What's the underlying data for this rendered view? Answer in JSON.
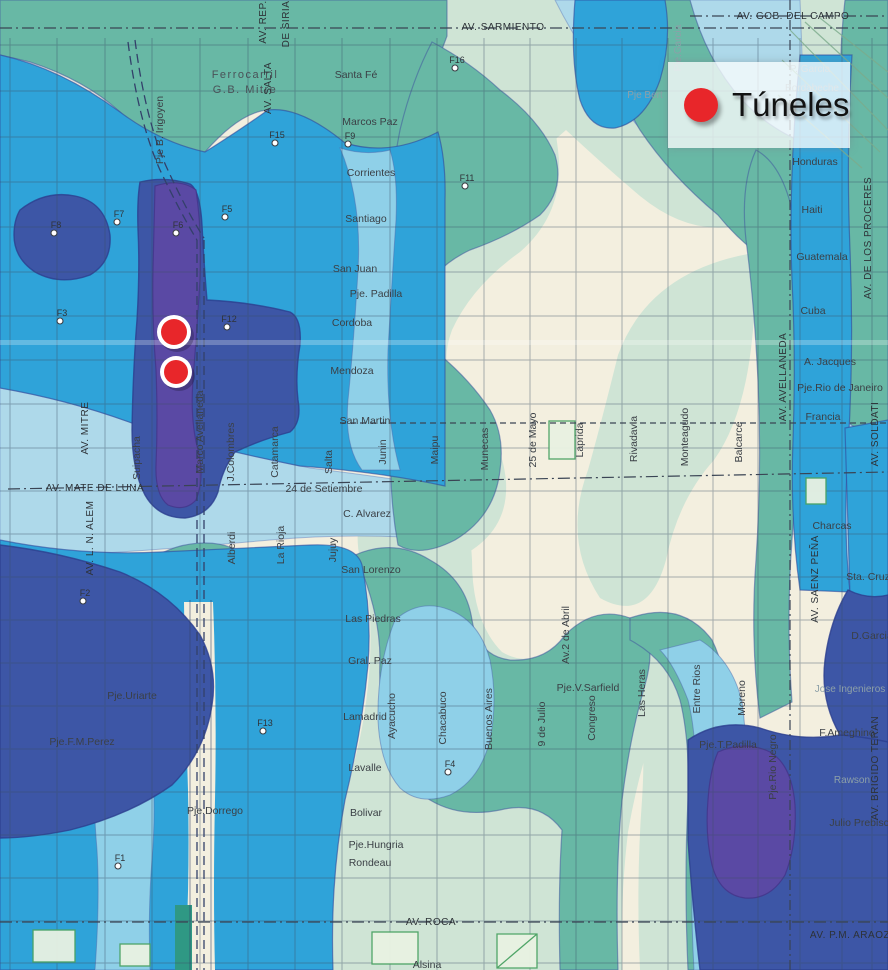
{
  "legend": {
    "title": "Túneles"
  },
  "colors": {
    "tunnel_red": "#e8262a",
    "navy": "#3d56a6",
    "purple": "#5a49a4",
    "blue": "#2fa3d9",
    "cyan": "#8fd0e8",
    "pale_blue": "#aed9ea",
    "teal": "#68b8a5",
    "pale_green": "#cfe4d5",
    "cream": "#f3efdf"
  },
  "tunnels": [
    {
      "x": 174,
      "y": 332,
      "r": 13
    },
    {
      "x": 176,
      "y": 372,
      "r": 12
    }
  ],
  "survey_points": [
    {
      "label": "F1",
      "x": 118,
      "y": 866
    },
    {
      "label": "F2",
      "x": 83,
      "y": 601
    },
    {
      "label": "F3",
      "x": 60,
      "y": 321
    },
    {
      "label": "F4",
      "x": 448,
      "y": 772
    },
    {
      "label": "F5",
      "x": 225,
      "y": 217
    },
    {
      "label": "F6",
      "x": 176,
      "y": 233
    },
    {
      "label": "F7",
      "x": 117,
      "y": 222
    },
    {
      "label": "F8",
      "x": 54,
      "y": 233
    },
    {
      "label": "F9",
      "x": 348,
      "y": 144
    },
    {
      "label": "F11",
      "x": 465,
      "y": 186
    },
    {
      "label": "F12",
      "x": 227,
      "y": 327
    },
    {
      "label": "F13",
      "x": 263,
      "y": 731
    },
    {
      "label": "F15",
      "x": 275,
      "y": 143
    },
    {
      "label": "F16",
      "x": 455,
      "y": 68
    }
  ],
  "labels": {
    "horizontal": [
      {
        "id": "av-sarmiento",
        "text": "AV. SARMIENTO",
        "x": 503,
        "y": 30,
        "cls": "avenue"
      },
      {
        "id": "av-gob-del-campo",
        "text": "AV. GOB. DEL CAMPO",
        "x": 793,
        "y": 19,
        "cls": "avenue"
      },
      {
        "id": "ferrocarril-1",
        "text": "Ferrocarril",
        "x": 245,
        "y": 78,
        "cls": "rail"
      },
      {
        "id": "ferrocarril-2",
        "text": "G.B. Mitre",
        "x": 245,
        "y": 93,
        "cls": "rail"
      },
      {
        "id": "santa-fe",
        "text": "Santa Fé",
        "x": 356,
        "y": 78,
        "cls": "street"
      },
      {
        "id": "marcos-paz",
        "text": "Marcos Paz",
        "x": 370,
        "y": 125,
        "cls": "street"
      },
      {
        "id": "corrientes",
        "text": "Corrientes",
        "x": 371,
        "y": 176,
        "cls": "street"
      },
      {
        "id": "santiago",
        "text": "Santiago",
        "x": 366,
        "y": 222,
        "cls": "street"
      },
      {
        "id": "san-juan",
        "text": "San Juan",
        "x": 355,
        "y": 272,
        "cls": "street"
      },
      {
        "id": "pje-padilla",
        "text": "Pje. Padilla",
        "x": 376,
        "y": 297,
        "cls": "street"
      },
      {
        "id": "cordoba",
        "text": "Cordoba",
        "x": 352,
        "y": 326,
        "cls": "street"
      },
      {
        "id": "mendoza",
        "text": "Mendoza",
        "x": 352,
        "y": 374,
        "cls": "street"
      },
      {
        "id": "san-martin",
        "text": "San Martin",
        "x": 365,
        "y": 424,
        "cls": "street"
      },
      {
        "id": "24-de-setiembre",
        "text": "24 de Setiembre",
        "x": 324,
        "y": 492,
        "cls": "street"
      },
      {
        "id": "c-alvarez",
        "text": "C. Alvarez",
        "x": 367,
        "y": 517,
        "cls": "street"
      },
      {
        "id": "san-lorenzo",
        "text": "San Lorenzo",
        "x": 371,
        "y": 573,
        "cls": "street"
      },
      {
        "id": "las-piedras",
        "text": "Las Piedras",
        "x": 373,
        "y": 622,
        "cls": "street"
      },
      {
        "id": "gral-paz",
        "text": "Gral. Paz",
        "x": 370,
        "y": 664,
        "cls": "street"
      },
      {
        "id": "lamadrid",
        "text": "Lamadrid",
        "x": 365,
        "y": 720,
        "cls": "street"
      },
      {
        "id": "lavalle",
        "text": "Lavalle",
        "x": 365,
        "y": 771,
        "cls": "street"
      },
      {
        "id": "bolivar",
        "text": "Bolivar",
        "x": 366,
        "y": 816,
        "cls": "street"
      },
      {
        "id": "pje-dorrego",
        "text": "Pje.Dorrego",
        "x": 215,
        "y": 814,
        "cls": "street"
      },
      {
        "id": "pje-hungria",
        "text": "Pje.Hungria",
        "x": 376,
        "y": 848,
        "cls": "street"
      },
      {
        "id": "rondeau",
        "text": "Rondeau",
        "x": 370,
        "y": 866,
        "cls": "street"
      },
      {
        "id": "av-roca",
        "text": "AV. ROCA",
        "x": 431,
        "y": 925,
        "cls": "avenue"
      },
      {
        "id": "alsina",
        "text": "Alsina",
        "x": 427,
        "y": 968,
        "cls": "street"
      },
      {
        "id": "av-mate-de-luna",
        "text": "AV. MATE DE LUNA",
        "x": 95,
        "y": 491,
        "cls": "avenue"
      },
      {
        "id": "pje-uriarte",
        "text": "Pje.Uriarte",
        "x": 132,
        "y": 699,
        "cls": "street"
      },
      {
        "id": "pje-fm-perez",
        "text": "Pje.F.M.Perez",
        "x": 82,
        "y": 745,
        "cls": "street"
      },
      {
        "id": "pje-v-sarfield",
        "text": "Pje.V.Sarfield",
        "x": 588,
        "y": 691,
        "cls": "street"
      },
      {
        "id": "pje-t-padilla",
        "text": "Pje.T.Padilla",
        "x": 728,
        "y": 748,
        "cls": "street"
      },
      {
        "id": "honduras",
        "text": "Honduras",
        "x": 815,
        "y": 165,
        "cls": "street"
      },
      {
        "id": "haiti",
        "text": "Haiti",
        "x": 812,
        "y": 213,
        "cls": "street"
      },
      {
        "id": "guatemala",
        "text": "Guatemala",
        "x": 822,
        "y": 260,
        "cls": "street"
      },
      {
        "id": "cuba",
        "text": "Cuba",
        "x": 813,
        "y": 314,
        "cls": "street"
      },
      {
        "id": "a-jacques",
        "text": "A. Jacques",
        "x": 830,
        "y": 365,
        "cls": "street"
      },
      {
        "id": "pje-rio-de-janeiro",
        "text": "Pje.Rio de Janeiro",
        "x": 840,
        "y": 391,
        "cls": "street"
      },
      {
        "id": "francia",
        "text": "Francia",
        "x": 823,
        "y": 420,
        "cls": "street"
      },
      {
        "id": "charcas",
        "text": "Charcas",
        "x": 832,
        "y": 529,
        "cls": "street"
      },
      {
        "id": "sta-cruz",
        "text": "Sta. Cruz",
        "x": 868,
        "y": 580,
        "cls": "street"
      },
      {
        "id": "d-garcia",
        "text": "D.Garcia",
        "x": 872,
        "y": 639,
        "cls": "street"
      },
      {
        "id": "jose-ingenieros",
        "text": "Jose Ingenieros",
        "x": 850,
        "y": 692,
        "cls": "faint"
      },
      {
        "id": "f-ameghino",
        "text": "F.Ameghino",
        "x": 847,
        "y": 736,
        "cls": "street"
      },
      {
        "id": "rawson",
        "text": "Rawson",
        "x": 852,
        "y": 783,
        "cls": "faint"
      },
      {
        "id": "julio-prebisch",
        "text": "Julio Prebisch",
        "x": 862,
        "y": 826,
        "cls": "street"
      },
      {
        "id": "p-garcia",
        "text": "P. Garcia",
        "x": 810,
        "y": 72,
        "cls": "faint"
      },
      {
        "id": "bordabeche",
        "text": "Bordabeche",
        "x": 812,
        "y": 91,
        "cls": "faint"
      },
      {
        "id": "pje-bert",
        "text": "Pje Bert",
        "x": 645,
        "y": 98,
        "cls": "faint"
      },
      {
        "id": "av-pm-araoz",
        "text": "AV. P.M. ARAOZ",
        "x": 850,
        "y": 938,
        "cls": "avenue"
      }
    ],
    "vertical": [
      {
        "id": "av-rep",
        "text": "AV. REP.",
        "x": 266,
        "y": 22,
        "cls": "avenue"
      },
      {
        "id": "de-siria",
        "text": "DE SIRIA",
        "x": 289,
        "y": 24,
        "cls": "avenue"
      },
      {
        "id": "av-salta",
        "text": "AV. SALTA",
        "x": 271,
        "y": 88,
        "cls": "avenue"
      },
      {
        "id": "pje-b-irigoyen",
        "text": "Pje B. Irigoyen",
        "x": 163,
        "y": 130,
        "cls": "street"
      },
      {
        "id": "pje-garcia",
        "text": "Pje.Garcia",
        "x": 681,
        "y": 48,
        "cls": "faint"
      },
      {
        "id": "av-de-los-proceres",
        "text": "AV. DE LOS PROCERES",
        "x": 871,
        "y": 238,
        "cls": "avenue"
      },
      {
        "id": "av-mitre",
        "text": "AV. MITRE",
        "x": 88,
        "y": 428,
        "cls": "avenue"
      },
      {
        "id": "av-l-n-alem",
        "text": "AV. L. N. ALEM",
        "x": 93,
        "y": 538,
        "cls": "avenue"
      },
      {
        "id": "suipacha",
        "text": "Suipacha",
        "x": 140,
        "y": 458,
        "cls": "street"
      },
      {
        "id": "marco-avellaneda",
        "text": "Marco Avellaneda",
        "x": 203,
        "y": 432,
        "cls": "street"
      },
      {
        "id": "j-colombres",
        "text": "J.Colombres",
        "x": 234,
        "y": 452,
        "cls": "street"
      },
      {
        "id": "catamarca",
        "text": "Catamarca",
        "x": 278,
        "y": 452,
        "cls": "street"
      },
      {
        "id": "salta",
        "text": "Salta",
        "x": 332,
        "y": 462,
        "cls": "street"
      },
      {
        "id": "junin",
        "text": "Junin",
        "x": 386,
        "y": 452,
        "cls": "street"
      },
      {
        "id": "maipu",
        "text": "Maipu",
        "x": 438,
        "y": 450,
        "cls": "street"
      },
      {
        "id": "munecas",
        "text": "Munecas",
        "x": 488,
        "y": 449,
        "cls": "street"
      },
      {
        "id": "25-de-mayo",
        "text": "25 de Mayo",
        "x": 536,
        "y": 440,
        "cls": "street"
      },
      {
        "id": "laprida",
        "text": "Laprida",
        "x": 583,
        "y": 440,
        "cls": "street"
      },
      {
        "id": "rivadavia",
        "text": "Rivadavia",
        "x": 637,
        "y": 439,
        "cls": "street"
      },
      {
        "id": "monteagudo",
        "text": "Monteagudo",
        "x": 688,
        "y": 437,
        "cls": "street"
      },
      {
        "id": "balcarce",
        "text": "Balcarce",
        "x": 742,
        "y": 442,
        "cls": "street"
      },
      {
        "id": "av-avellaneda",
        "text": "AV. AVELLANEDA",
        "x": 786,
        "y": 377,
        "cls": "avenue"
      },
      {
        "id": "av-soldati",
        "text": "AV. SOLDATI",
        "x": 878,
        "y": 434,
        "cls": "avenue"
      },
      {
        "id": "av-saenz-pena",
        "text": "AV. SAENZ PEÑA",
        "x": 818,
        "y": 579,
        "cls": "avenue"
      },
      {
        "id": "alberdi",
        "text": "Alberdi",
        "x": 235,
        "y": 548,
        "cls": "street"
      },
      {
        "id": "la-rioja",
        "text": "La Rioja",
        "x": 284,
        "y": 545,
        "cls": "street"
      },
      {
        "id": "jujuy",
        "text": "Jujuy",
        "x": 336,
        "y": 550,
        "cls": "street"
      },
      {
        "id": "ayacucho",
        "text": "Ayacucho",
        "x": 395,
        "y": 716,
        "cls": "street"
      },
      {
        "id": "chacabuco",
        "text": "Chacabuco",
        "x": 446,
        "y": 718,
        "cls": "street"
      },
      {
        "id": "buenos-aires",
        "text": "Buenos Aires",
        "x": 492,
        "y": 719,
        "cls": "street"
      },
      {
        "id": "9-de-julio",
        "text": "9 de Julio",
        "x": 545,
        "y": 724,
        "cls": "street"
      },
      {
        "id": "av-2-de-abril",
        "text": "Av.2 de Abril",
        "x": 569,
        "y": 635,
        "cls": "street"
      },
      {
        "id": "congreso",
        "text": "Congreso",
        "x": 595,
        "y": 718,
        "cls": "street"
      },
      {
        "id": "las-heras",
        "text": "Las Heras",
        "x": 645,
        "y": 693,
        "cls": "street"
      },
      {
        "id": "entre-rios",
        "text": "Entre Rios",
        "x": 700,
        "y": 689,
        "cls": "street"
      },
      {
        "id": "moreno",
        "text": "Moreno",
        "x": 745,
        "y": 698,
        "cls": "street"
      },
      {
        "id": "pje-rio-negro",
        "text": "Pje.Rio Negro",
        "x": 776,
        "y": 767,
        "cls": "street"
      },
      {
        "id": "av-brigido-teran",
        "text": "AV. BRIGIDO TERAN",
        "x": 878,
        "y": 768,
        "cls": "avenue"
      }
    ]
  }
}
